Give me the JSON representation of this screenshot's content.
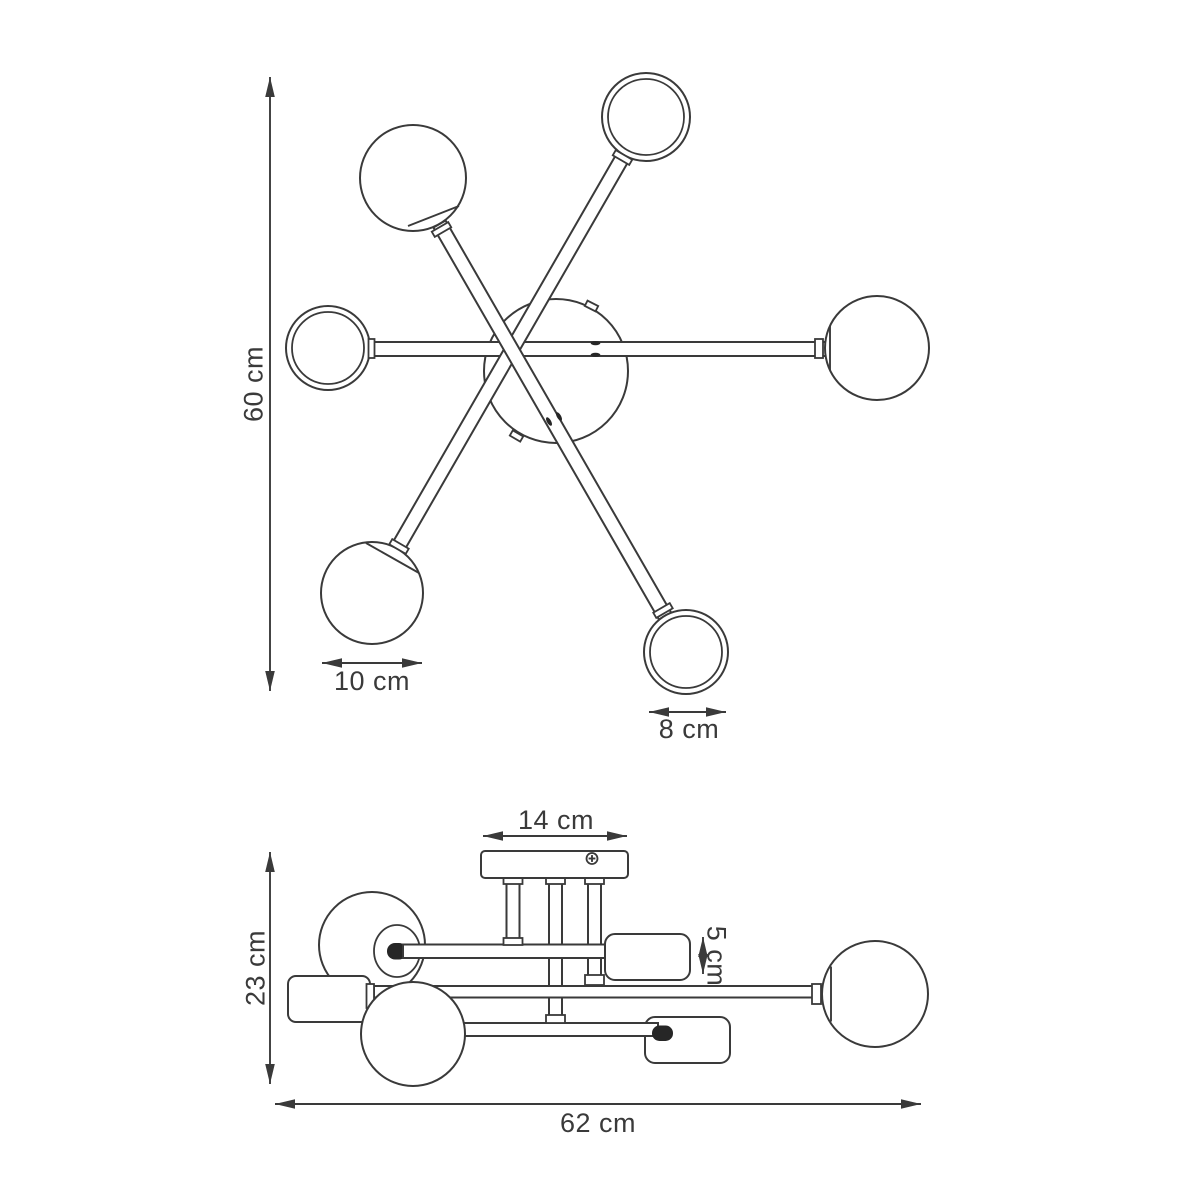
{
  "drawing": {
    "subject": "six-arm sputnik ceiling lamp technical dimension drawing",
    "background": "#ffffff",
    "colors": {
      "line": "#3a3a3a",
      "dark_detail": "#262626",
      "text": "#3a3a3a",
      "fill": "#ffffff"
    },
    "top_view": {
      "name": "top view",
      "globe_count": 6,
      "dimensions": {
        "overall_height": {
          "label": "60 cm",
          "orientation": "vertical"
        },
        "large_globe_diameter": {
          "label": "10 cm",
          "orientation": "horizontal"
        },
        "small_globe_diameter": {
          "label": "8 cm",
          "orientation": "horizontal"
        }
      }
    },
    "side_view": {
      "name": "side view",
      "dimensions": {
        "canopy_width": {
          "label": "14 cm",
          "orientation": "horizontal"
        },
        "socket_height": {
          "label": "5 cm",
          "orientation": "vertical"
        },
        "fixture_height": {
          "label": "23 cm",
          "orientation": "vertical"
        },
        "overall_width": {
          "label": "62 cm",
          "orientation": "horizontal"
        }
      }
    }
  }
}
